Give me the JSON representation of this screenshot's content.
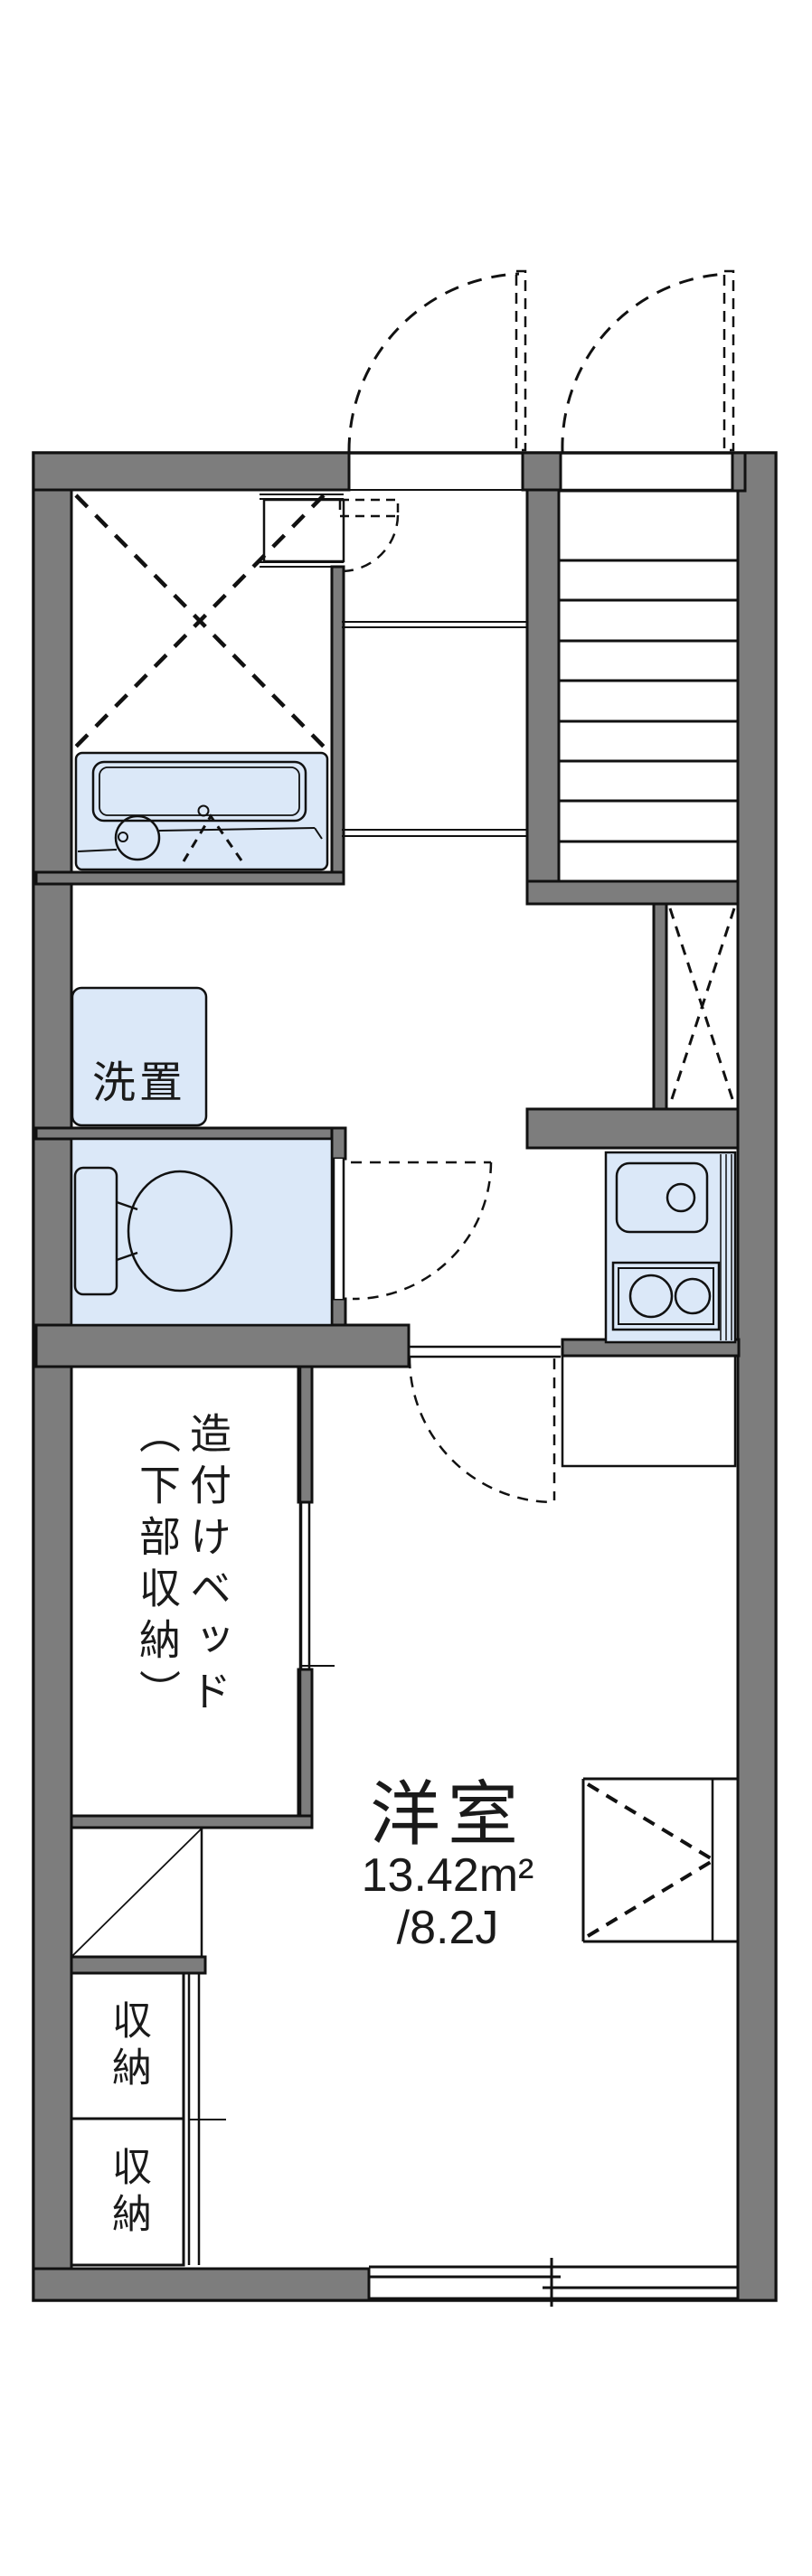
{
  "plan": {
    "type": "floorplan",
    "labels": {
      "washer": "洗置",
      "bed_line1": "造付けベッド",
      "bed_line2": "（下部収納）",
      "main_room_name": "洋室",
      "main_room_area": "13.42m²",
      "main_room_tatami": "/8.2J",
      "storage_1": "収納",
      "storage_2": "収納"
    },
    "colors": {
      "wall": "#7d7d7d",
      "stair_tread": "#c5c5c5",
      "water_fixture": "#dbe8f8",
      "cabinet": "#fdf2dd",
      "line": "#111111",
      "background": "#ffffff"
    }
  }
}
